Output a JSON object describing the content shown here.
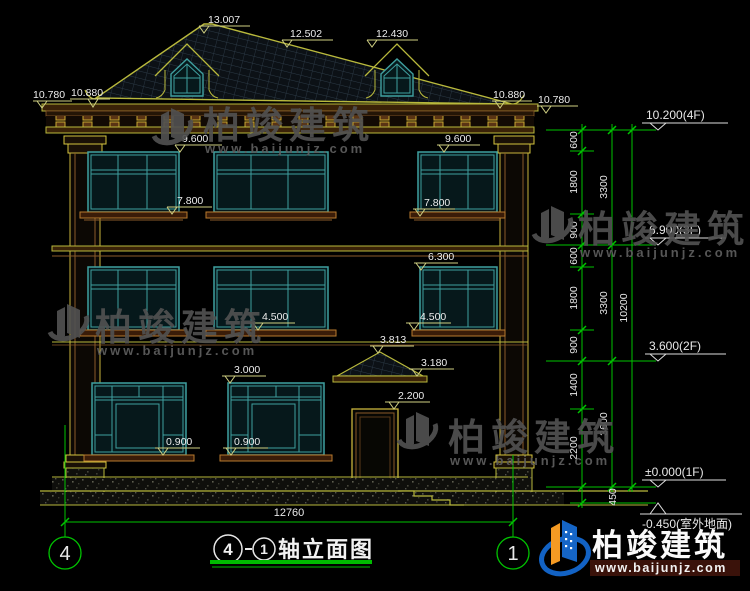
{
  "marks": {
    "ridge": "13.007",
    "roof_mid": "12.502",
    "dormer_right": "12.430",
    "eave_left_outer": "10.780",
    "eave_left_inner": "10.880",
    "eave_right_inner": "10.880",
    "eave_right_outer": "10.780",
    "f3_head_left": "9.600",
    "f3_head_right": "9.600",
    "f3_sill_left": "7.800",
    "f3_sill_right": "7.800",
    "f2_head": "6.300",
    "f2_sill_left": "4.500",
    "f2_sill_right": "4.500",
    "canopy_ridge": "3.813",
    "canopy_eave": "3.180",
    "f1_head": "3.000",
    "door_head": "2.200",
    "f1_sill_left": "0.900",
    "f1_sill_right": "0.900"
  },
  "levels": {
    "f4": "10.200(4F)",
    "f3": "6.900(3F)",
    "f2": "3.600(2F)",
    "f1": "±0.000(1F)",
    "outdoor": "-0.450(室外地面)"
  },
  "chain": {
    "tier1": [
      "600",
      "1800",
      "900",
      "600",
      "1800",
      "900",
      "1400",
      "2200"
    ],
    "below_ground": "450",
    "tier2": [
      "3300",
      "3300",
      "3600"
    ],
    "total": "10200"
  },
  "bottom": {
    "overall_width": "12760",
    "axis_left": "4",
    "axis_right": "1"
  },
  "title": {
    "axis_from": "4",
    "axis_to": "1",
    "text": "轴立面图"
  },
  "watermark": {
    "brand": "柏竣建筑",
    "url": "www.baijunjz.com"
  },
  "logo": {
    "brand": "柏竣建筑",
    "url": "www.baijunjz.com"
  }
}
